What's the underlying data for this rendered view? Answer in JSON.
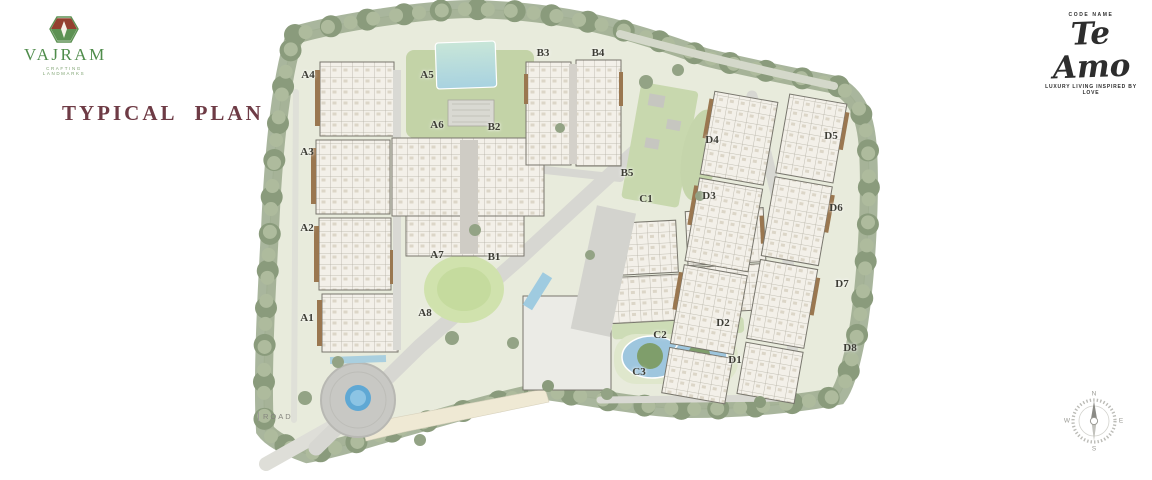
{
  "header": {
    "logo": {
      "name": "VAJRAM",
      "tagline": "CRAFTING LANDMARKS"
    },
    "title": "TYPICAL PLAN",
    "brand": {
      "kicker": "CODE NAME",
      "name": "Te Amo",
      "tagline": "LUXURY LIVING INSPIRED BY LOVE"
    }
  },
  "plan": {
    "block_labels": [
      {
        "label": "A4",
        "x": 308,
        "y": 75
      },
      {
        "label": "A5",
        "x": 427,
        "y": 75
      },
      {
        "label": "B3",
        "x": 543,
        "y": 53
      },
      {
        "label": "B4",
        "x": 598,
        "y": 53
      },
      {
        "label": "A6",
        "x": 437,
        "y": 125
      },
      {
        "label": "B2",
        "x": 494,
        "y": 127
      },
      {
        "label": "D4",
        "x": 712,
        "y": 140
      },
      {
        "label": "D5",
        "x": 831,
        "y": 136
      },
      {
        "label": "A3",
        "x": 307,
        "y": 152
      },
      {
        "label": "B5",
        "x": 627,
        "y": 173
      },
      {
        "label": "C1",
        "x": 646,
        "y": 199
      },
      {
        "label": "D3",
        "x": 709,
        "y": 196
      },
      {
        "label": "D6",
        "x": 836,
        "y": 208
      },
      {
        "label": "A2",
        "x": 307,
        "y": 228
      },
      {
        "label": "A7",
        "x": 437,
        "y": 255
      },
      {
        "label": "B1",
        "x": 494,
        "y": 257
      },
      {
        "label": "D7",
        "x": 842,
        "y": 284
      },
      {
        "label": "A1",
        "x": 307,
        "y": 318
      },
      {
        "label": "A8",
        "x": 425,
        "y": 313
      },
      {
        "label": "D2",
        "x": 723,
        "y": 323
      },
      {
        "label": "C2",
        "x": 660,
        "y": 335
      },
      {
        "label": "D8",
        "x": 850,
        "y": 348
      },
      {
        "label": "D1",
        "x": 735,
        "y": 360
      },
      {
        "label": "C3",
        "x": 639,
        "y": 372
      }
    ],
    "road_label": "ROAD",
    "compass": {
      "n": "N",
      "e": "E",
      "s": "S",
      "w": "W"
    }
  },
  "colors": {
    "title_maroon": "#6e3b45",
    "logo_green": "#4f8c4b",
    "tree_green": "#97a78a",
    "water_blue": "#9ec6de",
    "building_fill": "#f3f0e9",
    "accent_brown": "#9a7750"
  }
}
